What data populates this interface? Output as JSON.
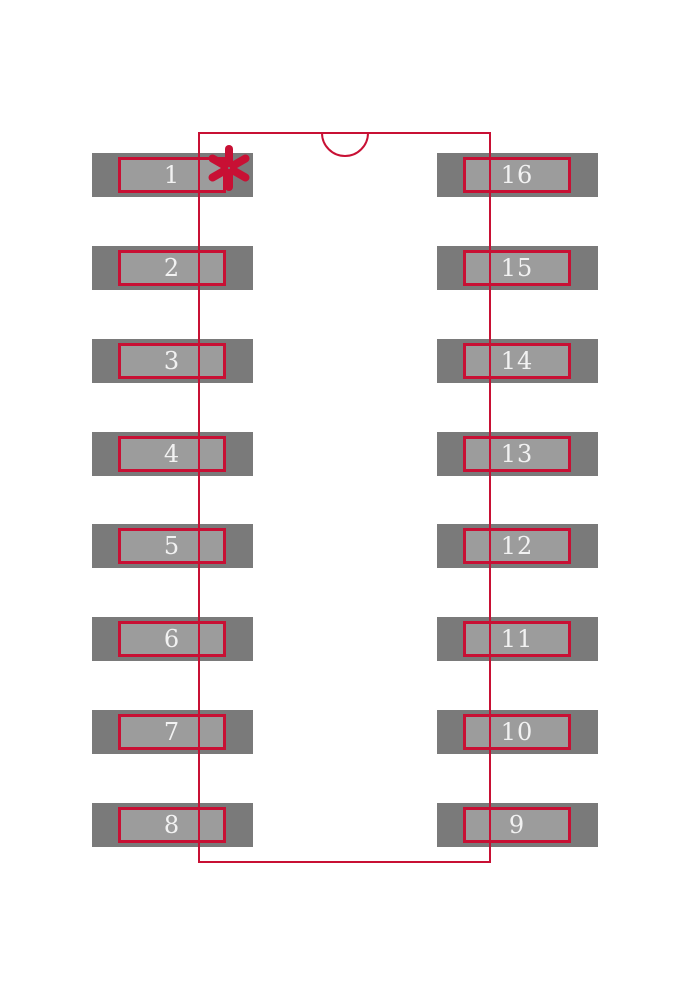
{
  "meta": {
    "description": "16-pad dual-row IC footprint land pattern with body outline, index notch and pin-1 asterisk marker"
  },
  "colors": {
    "background": "#ffffff",
    "pad_dark": "#7a7a7a",
    "pad_light": "#9c9c9c",
    "outline_red": "#c81034",
    "pin_number_text": "#f2f2f2"
  },
  "geometry": {
    "canvas": {
      "width": 690,
      "height": 1000
    },
    "body_outline": {
      "x": 199,
      "y": 133,
      "width": 291,
      "height": 729,
      "stroke_width": 2
    },
    "notch": {
      "cx": 345,
      "cy": 133,
      "r": 23,
      "stroke_width": 2
    },
    "pin1_marker": {
      "cx": 229,
      "cy": 168,
      "arm_inner": 5,
      "arm_outer": 19,
      "stroke_width": 8
    },
    "pad": {
      "outer_width": 161,
      "outer_height": 44,
      "inner_width": 108,
      "inner_height": 36,
      "border_width": 3,
      "left_outer_x": 92,
      "left_inner_x": 118,
      "right_outer_x": 437,
      "right_inner_x": 463
    },
    "row_centers_y": [
      175,
      268,
      361,
      454,
      546,
      639,
      732,
      825
    ]
  },
  "pads": {
    "left": [
      {
        "label": "1"
      },
      {
        "label": "2"
      },
      {
        "label": "3"
      },
      {
        "label": "4"
      },
      {
        "label": "5"
      },
      {
        "label": "6"
      },
      {
        "label": "7"
      },
      {
        "label": "8"
      }
    ],
    "right": [
      {
        "label": "16"
      },
      {
        "label": "15"
      },
      {
        "label": "14"
      },
      {
        "label": "13"
      },
      {
        "label": "12"
      },
      {
        "label": "11"
      },
      {
        "label": "10"
      },
      {
        "label": "9"
      }
    ]
  }
}
